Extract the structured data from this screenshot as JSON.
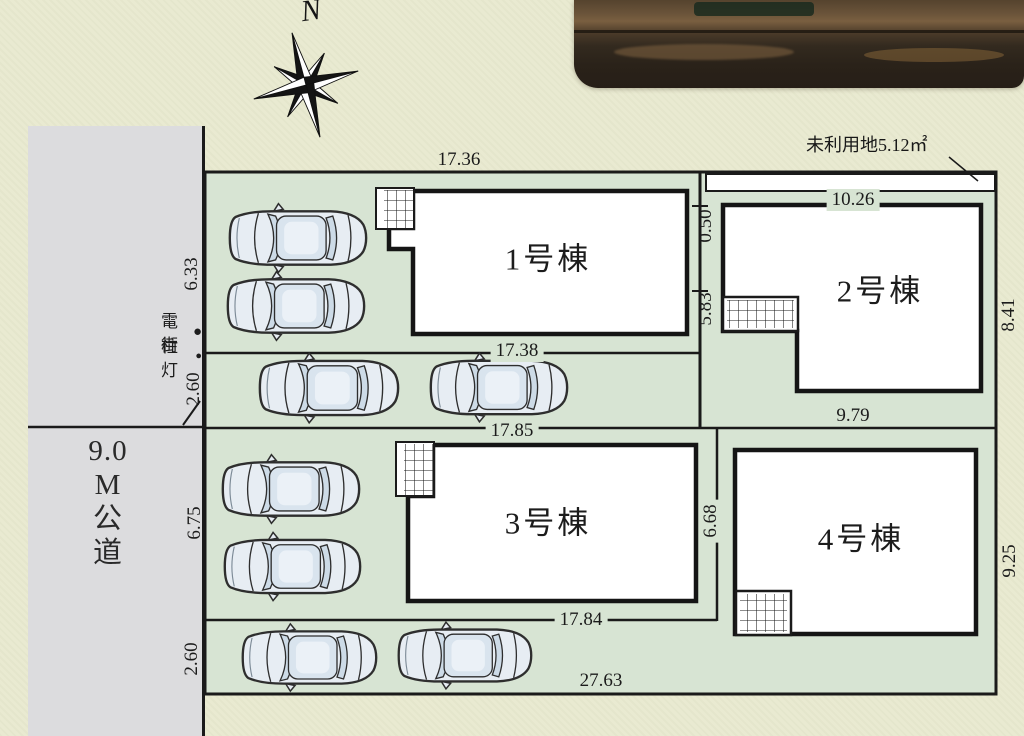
{
  "plan": {
    "north": "N",
    "legend": {
      "pole": "電柱",
      "pole_bullet": "●",
      "light": "街灯",
      "light_bullet": "●"
    },
    "road": {
      "lines": [
        "9.0",
        "M",
        "公",
        "道"
      ]
    },
    "unused_land": "未利用地5.12㎡",
    "buildings": {
      "b1": "1号棟",
      "b2": "2号棟",
      "b3": "3号棟",
      "b4": "4号棟"
    },
    "dims": {
      "w1736": "17.36",
      "w1738": "17.38",
      "h050": "0.50",
      "h583": "5.83",
      "w1026": "10.26",
      "h841": "8.41",
      "w979": "9.79",
      "w1785": "17.85",
      "h668": "6.68",
      "w1784": "17.84",
      "h925": "9.25",
      "w2763": "27.63",
      "h633": "6.33",
      "h260a": "2.60",
      "h675": "6.75",
      "h260b": "2.60"
    }
  }
}
